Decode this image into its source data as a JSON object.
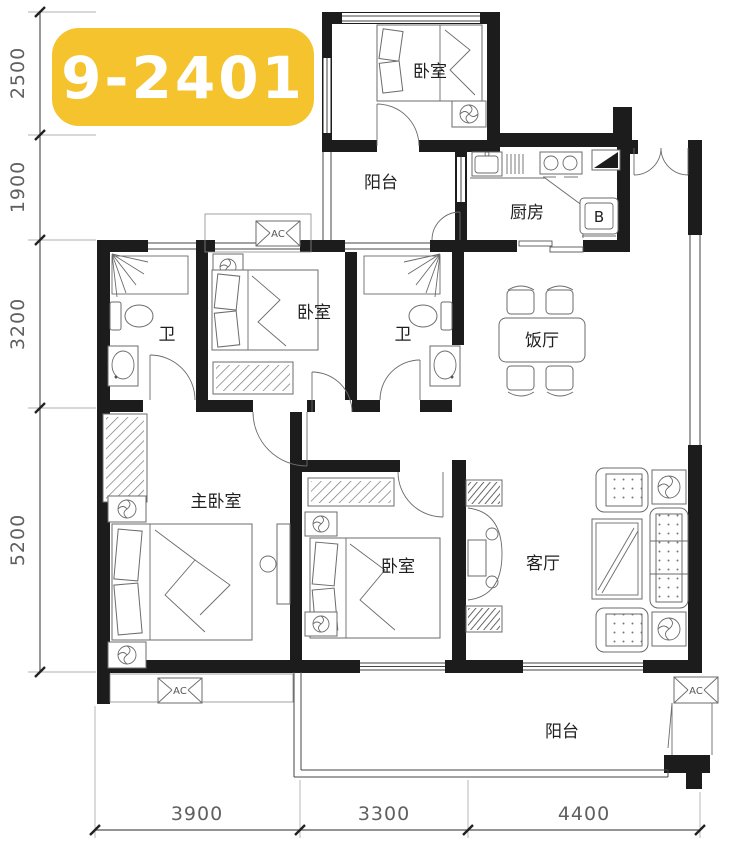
{
  "badge": {
    "label": "9-2401",
    "bg": "#F5C32D",
    "fg": "#FFFFFF"
  },
  "rooms": {
    "bedroom_top": "卧室",
    "balcony_top": "阳台",
    "kitchen": "厨房",
    "bath_left": "卫",
    "bedroom_mid": "卧室",
    "bath_right": "卫",
    "dining": "饭厅",
    "master_bedroom": "主卧室",
    "bedroom_lower": "卧室",
    "living": "客厅",
    "balcony_bottom": "阳台"
  },
  "appliances": {
    "ac_label": "AC",
    "fridge_label": "B"
  },
  "dimensions": {
    "left": [
      "2500",
      "1900",
      "3200",
      "5200"
    ],
    "bottom": [
      "3900",
      "3300",
      "4400"
    ]
  },
  "colors": {
    "wall": "#1c1c1c",
    "badge_bg": "#F5C32D",
    "dim_text": "#606060"
  }
}
